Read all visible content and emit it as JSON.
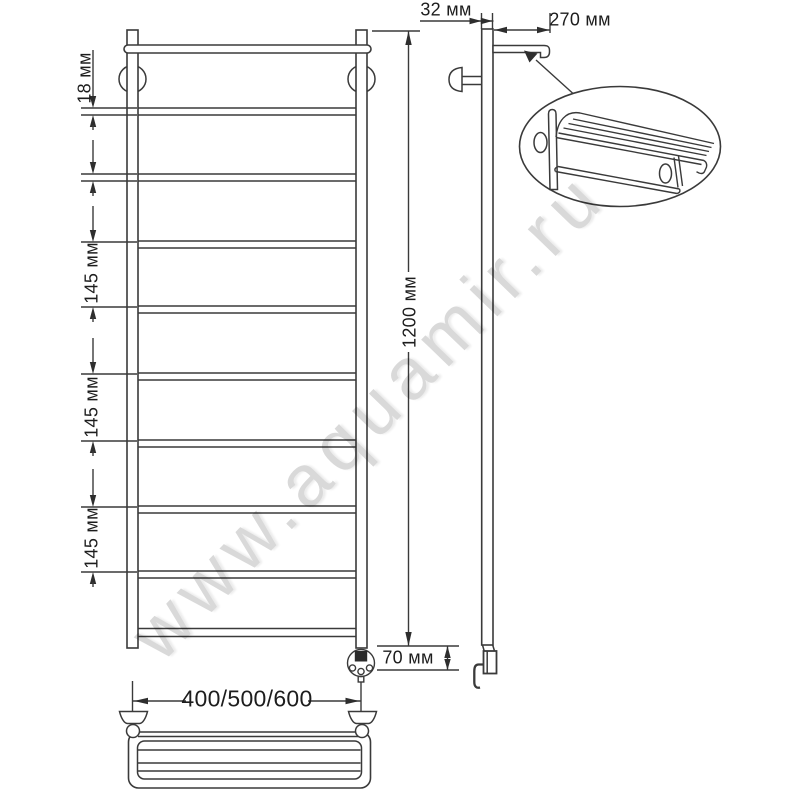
{
  "watermark": {
    "text": "www.aquamir.ru"
  },
  "dimensions": {
    "tube_diameter": "18 мм",
    "rung_spacing_1": "145 мм",
    "rung_spacing_2": "145 мм",
    "rung_spacing_3": "145 мм",
    "total_height": "1200 мм",
    "pipe_offset": "32 мм",
    "shelf_depth": "270 мм",
    "bottom_clearance": "70 мм",
    "width_variants": "400/500/600"
  }
}
